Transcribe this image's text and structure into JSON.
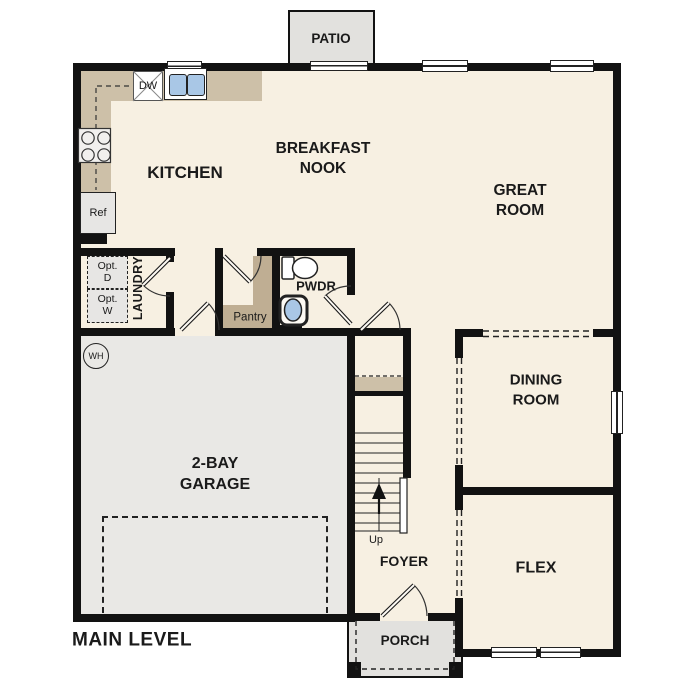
{
  "title": "MAIN LEVEL",
  "colors": {
    "floor": "#f7f0e2",
    "garage": "#e9e8e5",
    "outdoor": "#e2e1de",
    "counter": "#cdc0a8",
    "shelf": "#bfae93",
    "wall": "#121212",
    "water": "#a9c7e6",
    "text": "#1a1a1a"
  },
  "rooms": {
    "patio": "PATIO",
    "kitchen": "KITCHEN",
    "breakfast_nook": {
      "line1": "BREAKFAST",
      "line2": "NOOK"
    },
    "great_room": {
      "line1": "GREAT",
      "line2": "ROOM"
    },
    "laundry": "LAUNDRY",
    "pwdr": "PWDR",
    "pantry": "Pantry",
    "garage": {
      "line1": "2-BAY",
      "line2": "GARAGE"
    },
    "dining": {
      "line1": "DINING",
      "line2": "ROOM"
    },
    "flex": "FLEX",
    "foyer": "FOYER",
    "porch": "PORCH"
  },
  "fixtures": {
    "dishwasher": "DW",
    "refrigerator": "Ref",
    "opt_dryer": {
      "line1": "Opt.",
      "line2": "D"
    },
    "opt_washer": {
      "line1": "Opt.",
      "line2": "W"
    },
    "water_heater": "WH",
    "stairs_up": "Up"
  }
}
